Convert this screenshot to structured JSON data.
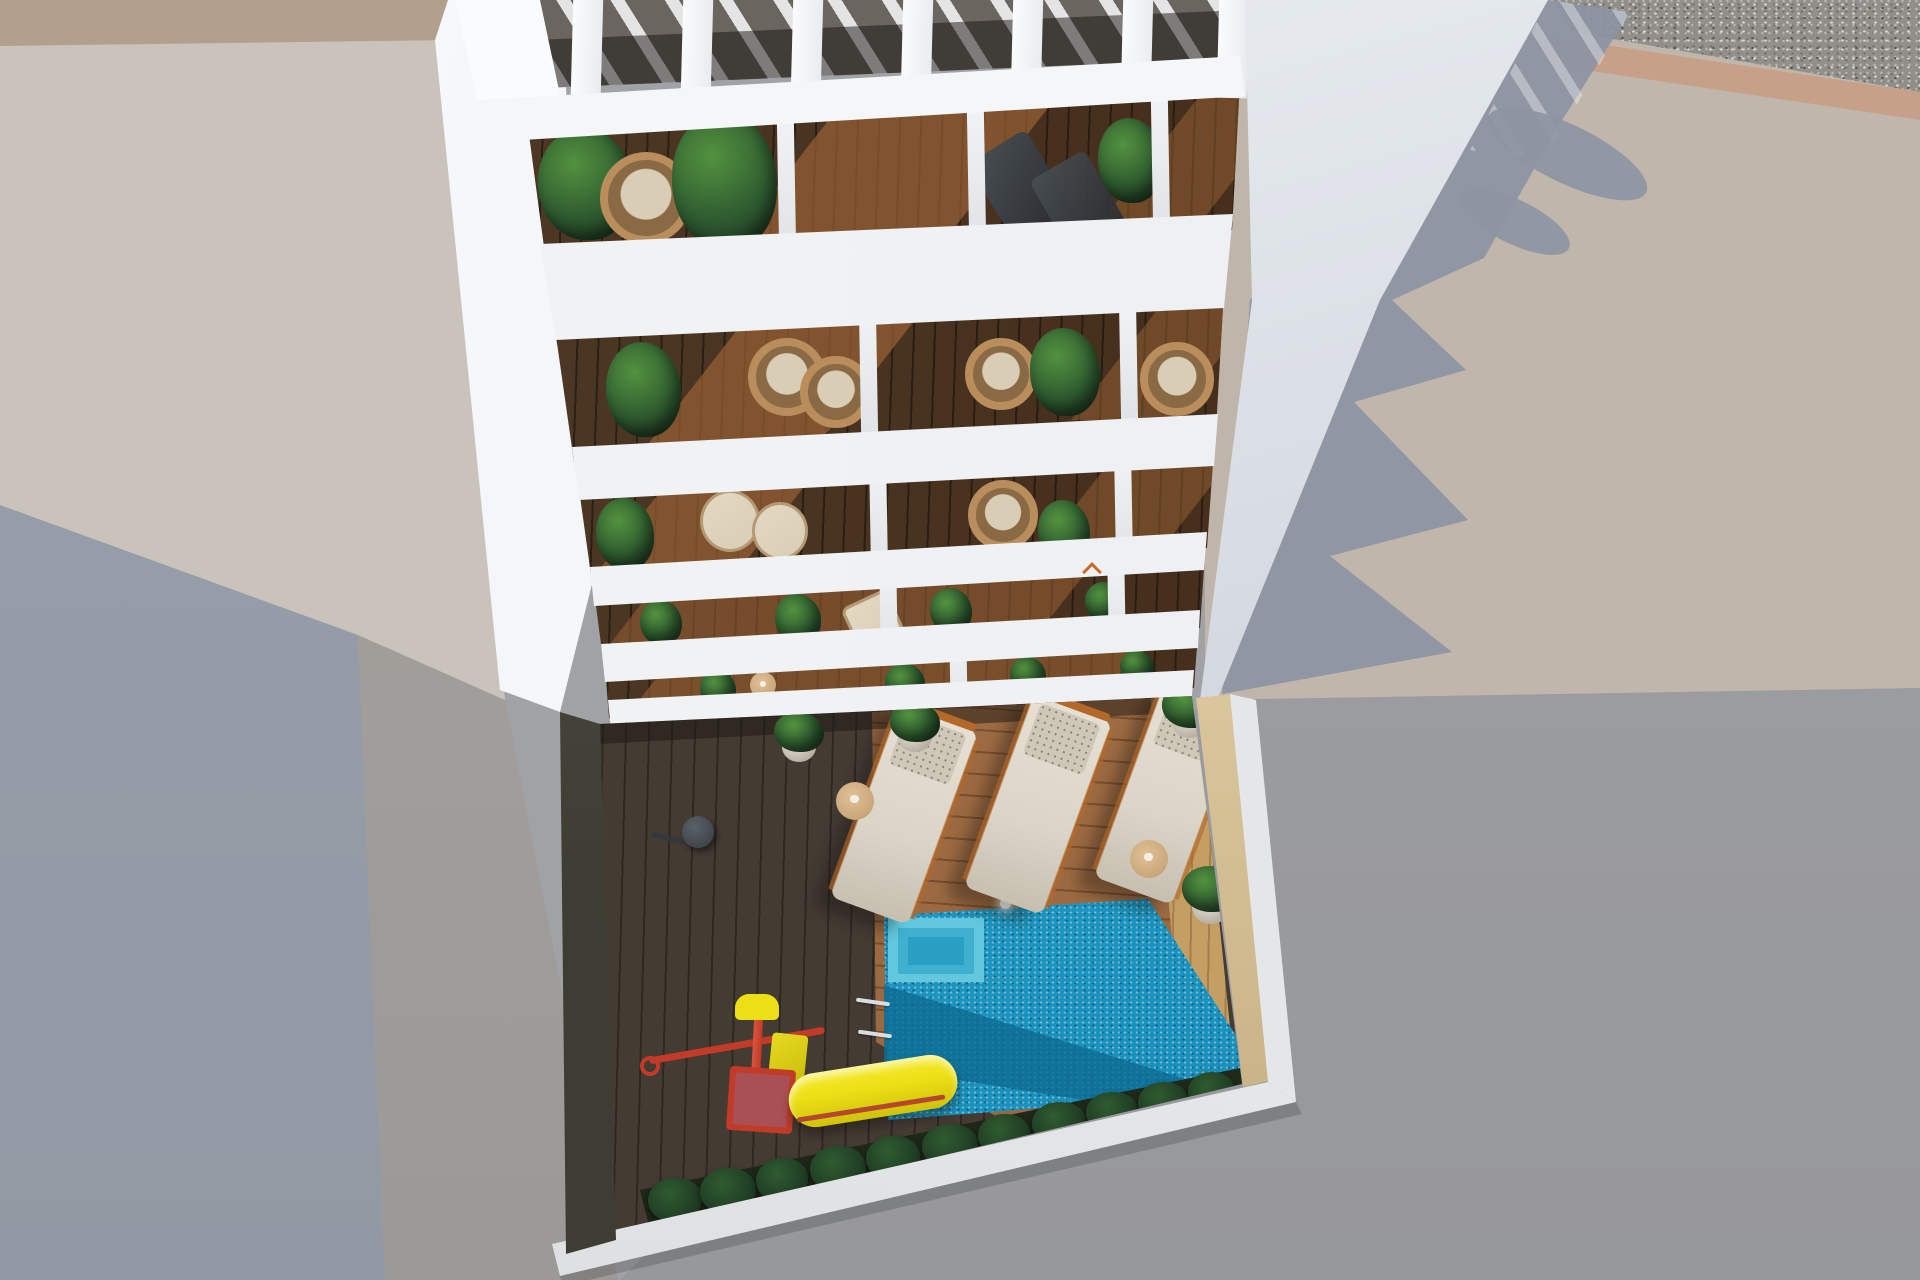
{
  "scene": {
    "label": "Aerial 3D architectural render of a white apartment tower seen from above, with slatted pergola roof, five rows of balconies with plants and chairs, and a ground-floor courtyard with wooden deck, swimming pool, sun loungers and a children's slide",
    "view": "top-down aerial",
    "time_of_day": "sunny daylight, long shadows to the right"
  },
  "colors": {
    "base": "#a1a2a6",
    "pavement-warm": "#b5aba2",
    "pavement-warm2": "#c0b6ac",
    "pavement-lower": "#9fa0a4",
    "shadow-blue": "#8d95a2",
    "slab-warm": "#c9c3bc",
    "slab-beige": "#b1a08e",
    "bottomleft-blue": "#98a0ab",
    "midleft-warm": "#a7a19c",
    "gravel": "#908f8b",
    "tan-border": "#c7a08a",
    "white-slab": "#f3f4f6",
    "white-bright": "#fafbfd",
    "wall-band-light": "#e9edf1",
    "wall-band-dark": "#c7cdd6",
    "wood-dark": "#46301d",
    "wood-sun": "#9a6134",
    "deck-shadow": "#443b33",
    "deck-sun": "#9c6a42",
    "deck-light": "#c59e63",
    "pool": "#1f9dc6",
    "pool-deep": "#0d6a92",
    "pool-light": "#43b5d4",
    "pool-step": "#63c8de",
    "parapet": "#eff1f3",
    "wall-tan": "#dcc8a0",
    "wall-tan2": "#c3ab7c",
    "soil-green": "#2c3a24",
    "plant-dark": "#1d3822",
    "plant-mid": "#2f5c30",
    "plant-light": "#53923f",
    "wicker": "#b98d5c",
    "wicker-dark": "#8a6a44",
    "cushion": "#d9cdb6",
    "chair-dark2": "#23262a",
    "lounger": "#dbd5c8",
    "lounger-head": "#cfc8b9",
    "frame-orange": "#b4692a",
    "slide-yellow": "#ecdf16",
    "slide-yellow2": "#cfc20a",
    "play-red": "#c23a28",
    "play-pink": "#a85056",
    "table-tan": "#c9a77a",
    "leftwall-dark": "#3e3d33",
    "leftwall-light": "#5a564c",
    "shower": "#41464c"
  },
  "building": {
    "label": "white apartment tower",
    "pergola_slat_count": 7,
    "balcony_rows": 5,
    "balcony_floor": "dark hardwood planks",
    "furniture": [
      "wicker round chairs",
      "cream cushioned chairs",
      "dark grey deck chairs",
      "potted plants",
      "small round table"
    ]
  },
  "courtyard": {
    "label": "ground-floor courtyard",
    "pool": {
      "label": "swimming pool",
      "water": "turquoise",
      "has_lamp": true,
      "has_ladder": true,
      "has_corner_steps": true
    },
    "lounger_count": 3,
    "side_table_count": 2,
    "potted_plant_count": 4,
    "playground": {
      "slide_color": "yellow",
      "frame_color": "red",
      "box_color": "pink"
    },
    "has_shower": true,
    "planter_bushes": 11
  },
  "ground": {
    "top_right": "gravel strip with tan kerb",
    "left": "warm concrete roof slab of neighbouring building",
    "right": "sunlit pavement with jagged cast shadow of the tower",
    "bottom_left": "blue-grey shaded pavement"
  }
}
